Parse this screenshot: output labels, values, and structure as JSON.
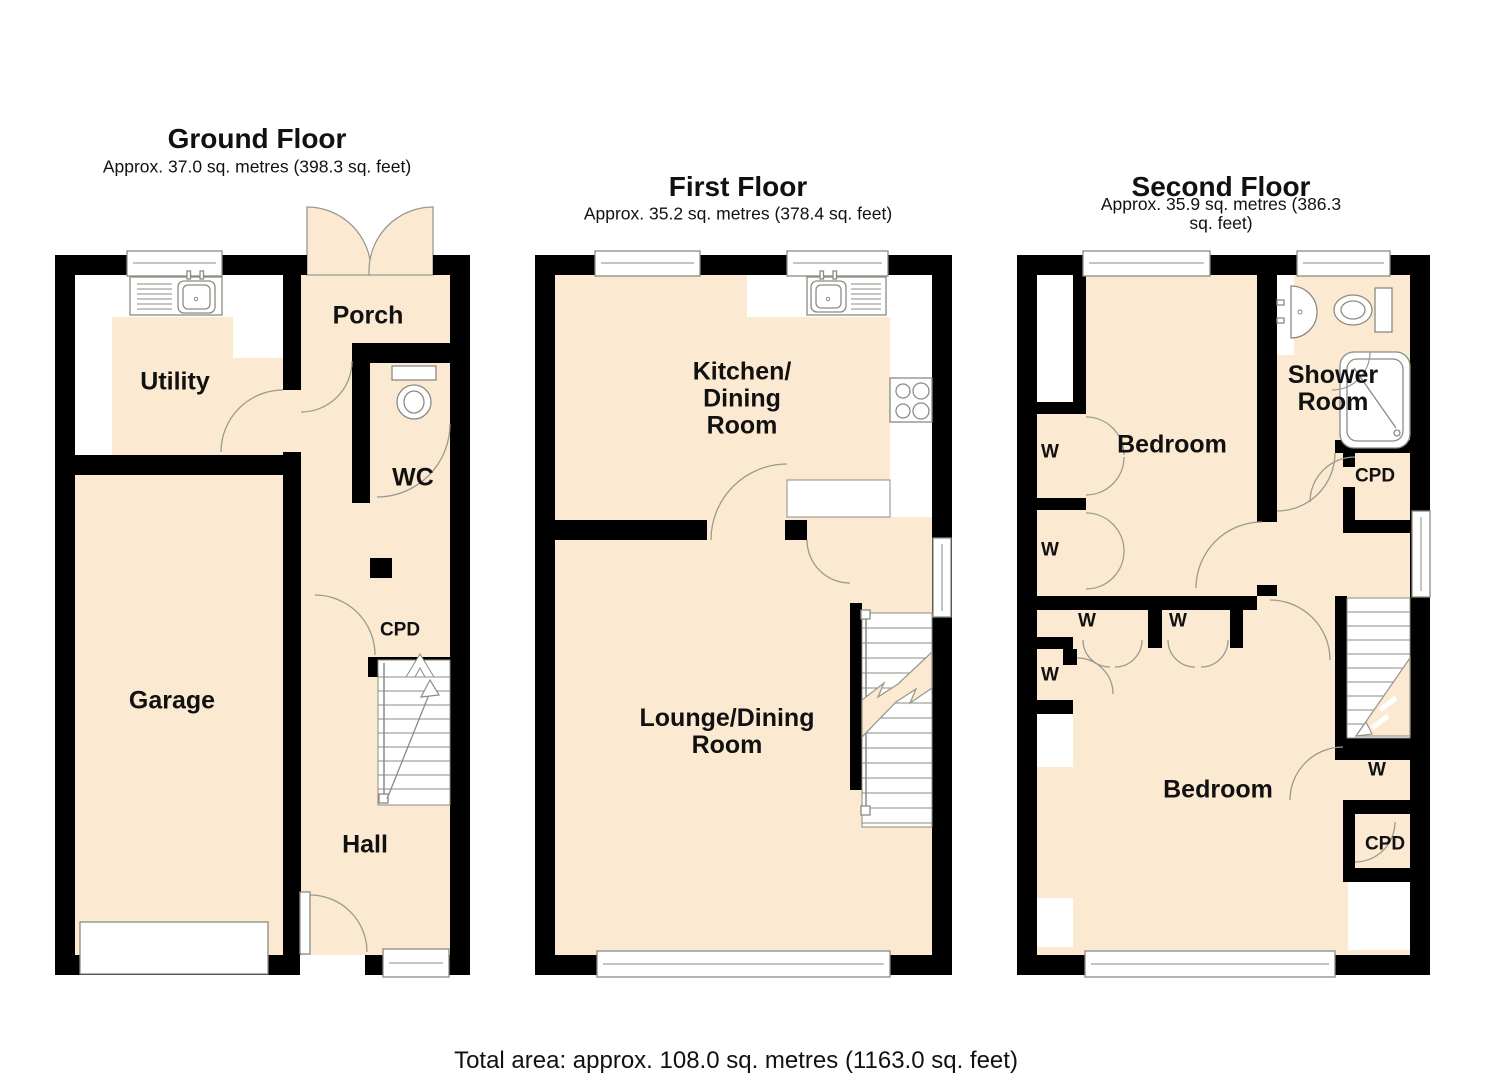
{
  "total_area_label": "Total area: approx. 108.0 sq. metres (1163.0 sq. feet)",
  "colors": {
    "floor_fill": "#fbead1",
    "wall": "#000000",
    "fixture_stroke": "#8b8b83",
    "text": "#111111"
  },
  "floors": [
    {
      "id": "ground",
      "title": "Ground Floor",
      "subtitle": "Approx. 37.0 sq. metres (398.3 sq. feet)",
      "rooms": {
        "porch": "Porch",
        "utility": "Utility",
        "wc": "WC",
        "cpd": "CPD",
        "garage": "Garage",
        "hall": "Hall"
      }
    },
    {
      "id": "first",
      "title": "First Floor",
      "subtitle": "Approx. 35.2 sq. metres (378.4 sq. feet)",
      "rooms": {
        "kitchen_dining": "Kitchen/\nDining\nRoom",
        "lounge_dining": "Lounge/Dining\nRoom"
      }
    },
    {
      "id": "second",
      "title": "Second Floor",
      "subtitle": "Approx. 35.9 sq. metres (386.3 sq. feet)",
      "rooms": {
        "bedroom_front": "Bedroom",
        "shower_room": "Shower\nRoom",
        "bedroom_back": "Bedroom",
        "wardrobe": "W",
        "cupboard": "CPD"
      }
    }
  ]
}
